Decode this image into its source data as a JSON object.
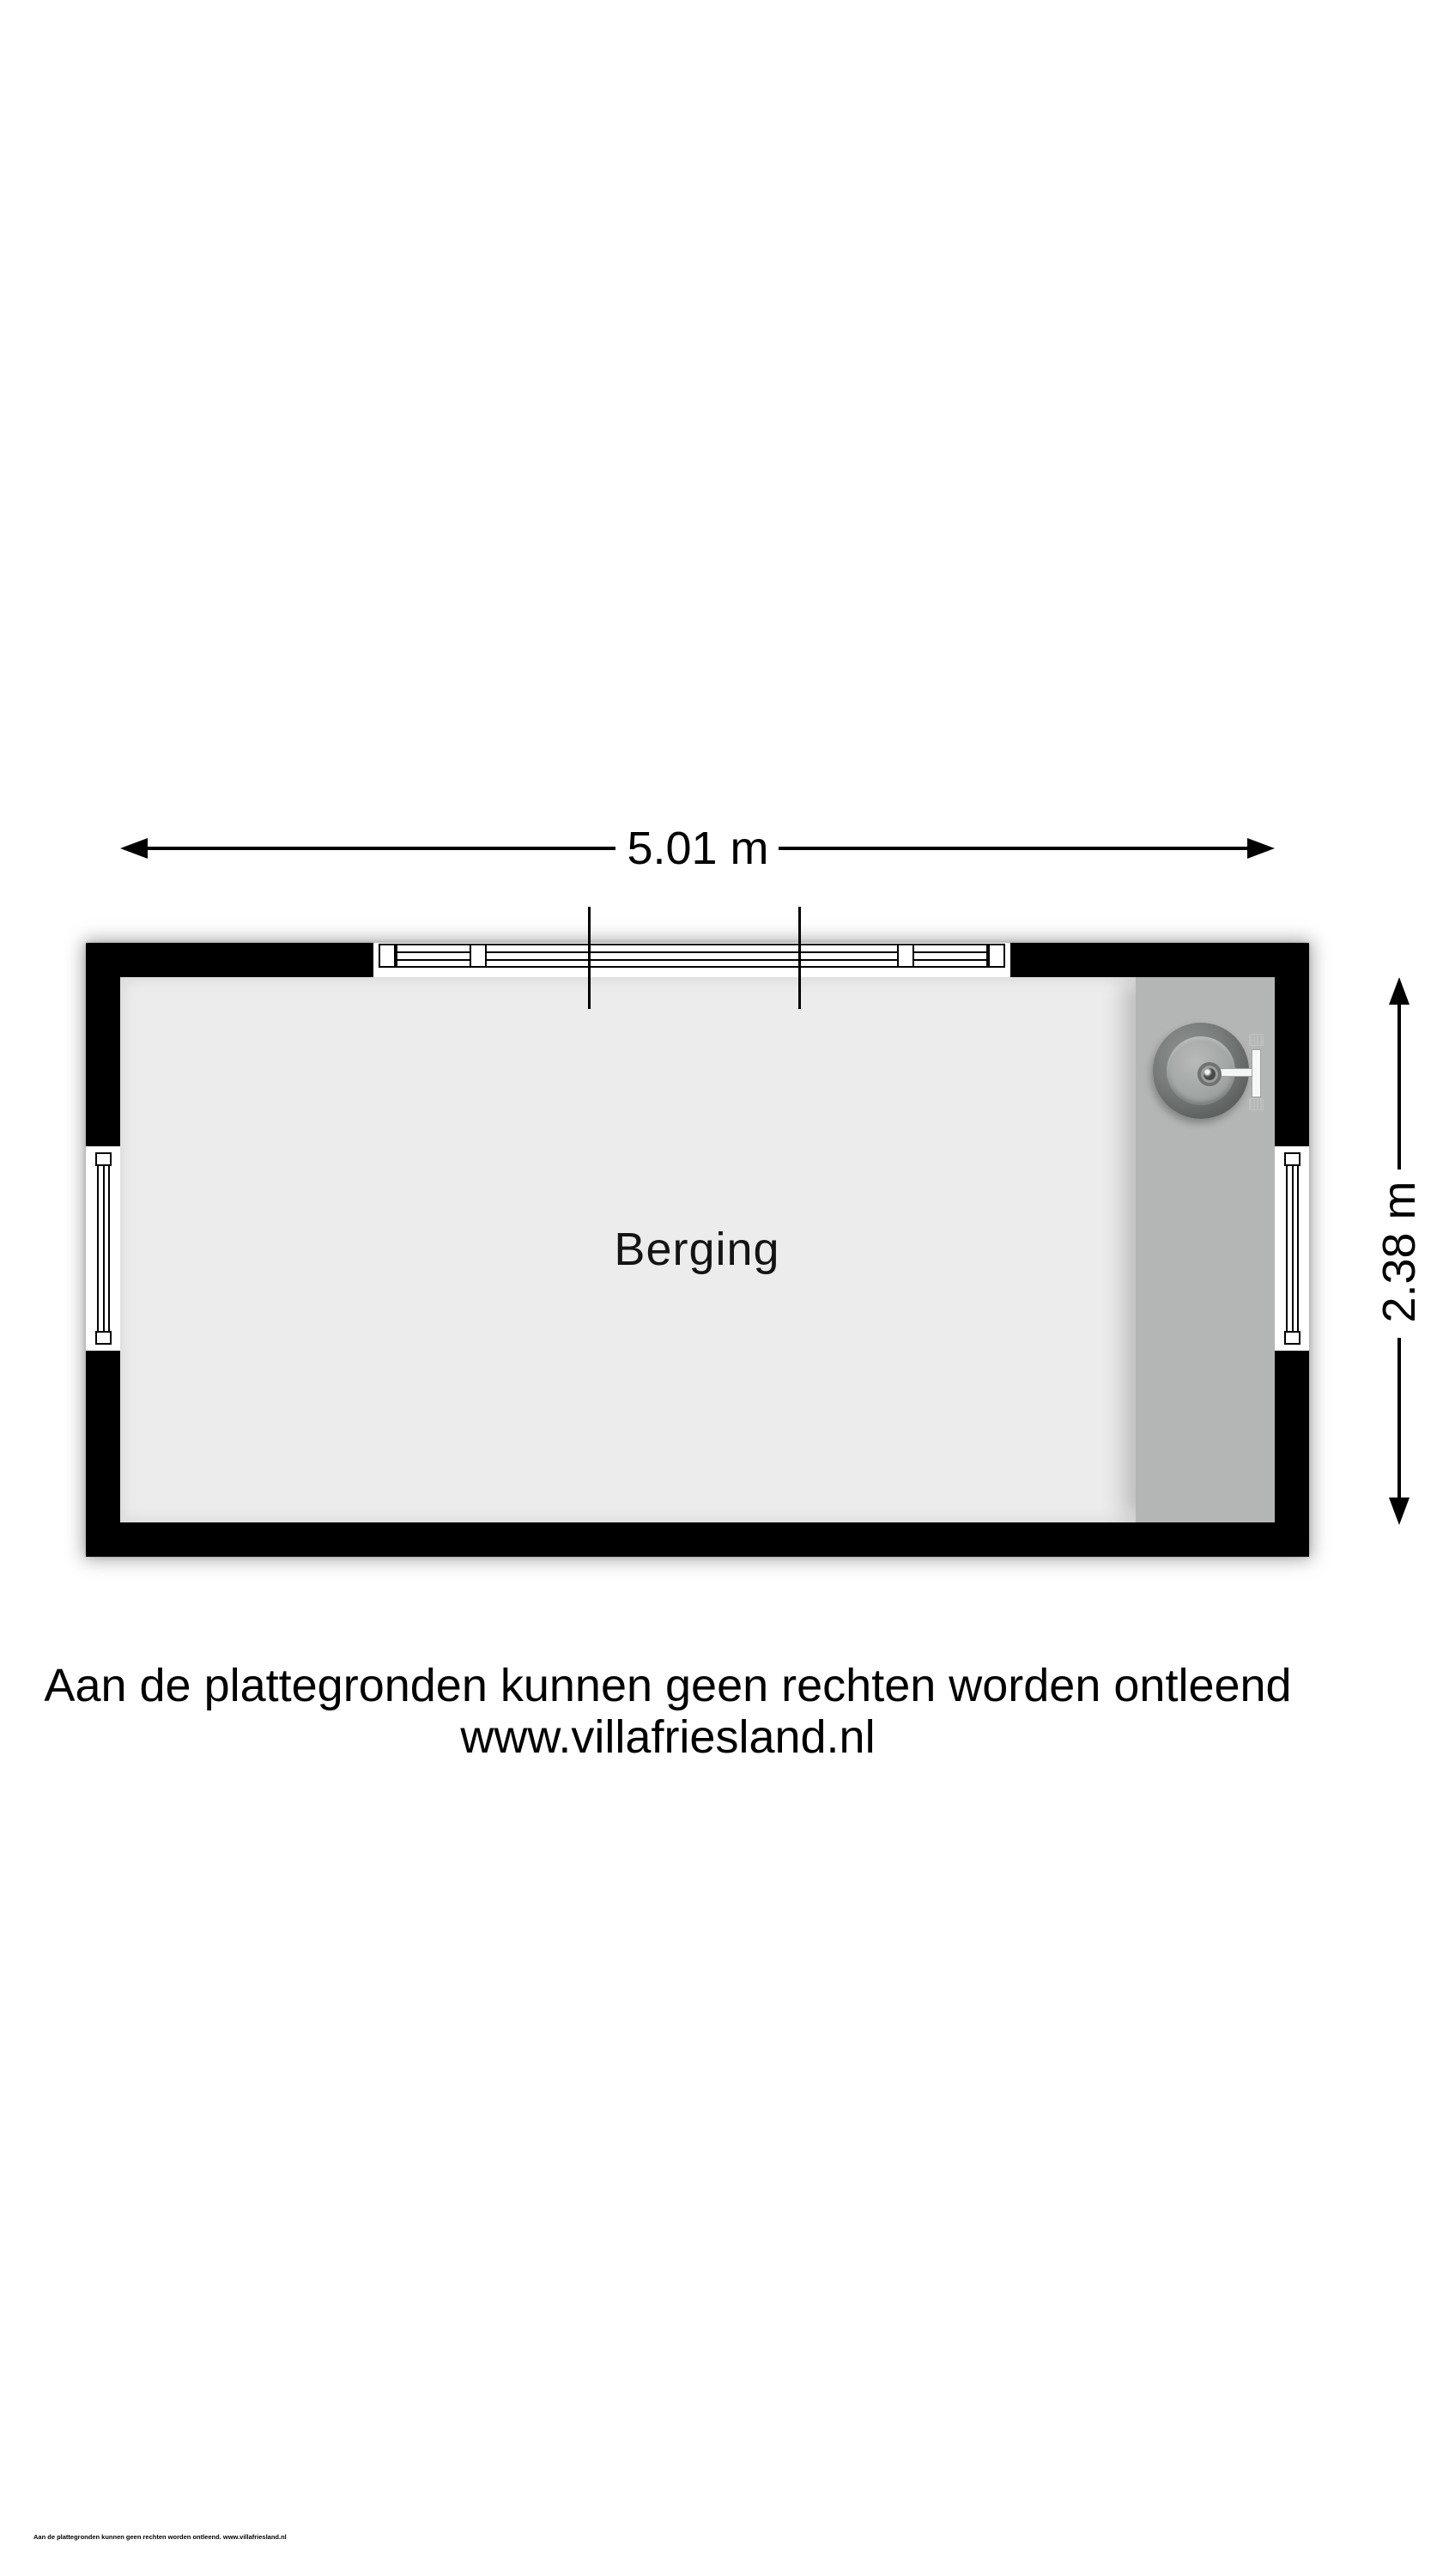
{
  "floorplan": {
    "room": {
      "label": "Berging"
    },
    "dimensions": {
      "width": {
        "label": "5.01 m"
      },
      "height": {
        "label": "2.38 m"
      }
    },
    "colors": {
      "wall": "#000000",
      "floor": "#ececec",
      "counter": "#b4b6b5",
      "background": "#ffffff"
    },
    "icons": {
      "sink": "sink-top-view-icon",
      "arrowheads": "dimension-arrowhead-icons",
      "windows": "double-line-window-symbols"
    }
  },
  "disclaimer": {
    "line1": "Aan de plattegronden kunnen geen rechten worden ontleend",
    "line2": "www.villafriesland.nl"
  },
  "footnote": {
    "text": "Aan de plattegronden kunnen geen rechten worden ontleend. www.villafriesland.nl"
  }
}
